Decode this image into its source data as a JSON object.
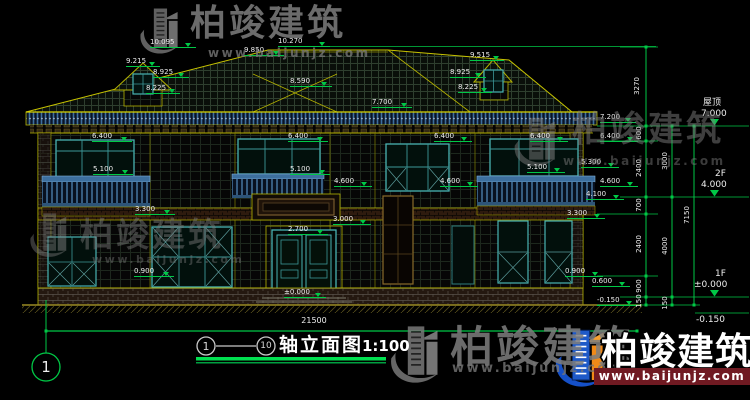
{
  "watermark": {
    "brand": "柏竣建筑",
    "url": "www.baijunjz.com"
  },
  "title_block": {
    "axis_from": "1",
    "axis_to": "10",
    "name": "轴立面图",
    "scale": "1:100"
  },
  "axis_bubble": {
    "label": "1"
  },
  "levels": [
    {
      "label": "屋顶",
      "value": "7.000"
    },
    {
      "label": "2F",
      "value": "4.000"
    },
    {
      "label": "1F",
      "value": "±0.000"
    },
    {
      "label": "",
      "value": "-0.150"
    }
  ],
  "dims": {
    "top_right_vertical": "3270",
    "total_width": "21500",
    "chain_a": [
      "600",
      "2400",
      "700",
      "2400",
      "900",
      "150"
    ],
    "chain_b": [
      "3000",
      "4000",
      "150"
    ],
    "chain_c": [
      "7150"
    ]
  },
  "annotations": [
    "10.095",
    "9.215",
    "8.925",
    "8.225",
    "10.270",
    "9.850",
    "8.590",
    "7.700",
    "9.515",
    "8.925",
    "8.225",
    "7.200",
    "6.400",
    "6.400",
    "6.400",
    "6.400",
    "6.400",
    "5.100",
    "5.100",
    "5.100",
    "5.300",
    "4.600",
    "4.600",
    "4.600",
    "4.100",
    "3.300",
    "3.300",
    "3.000",
    "2.700",
    "0.900",
    "0.900",
    "0.600",
    "±0.000",
    "-0.150"
  ],
  "colors": {
    "dimension_green": "#00c846",
    "outline_yellow": "#b5b300",
    "window_cyan": "#49b3b3",
    "railing_blue": "#3d6f9e",
    "watermark_gray": "#7e7e7e",
    "logo_blue": "#1f5ac8",
    "logo_orange": "#f08a18",
    "banner_red": "#701a22"
  }
}
